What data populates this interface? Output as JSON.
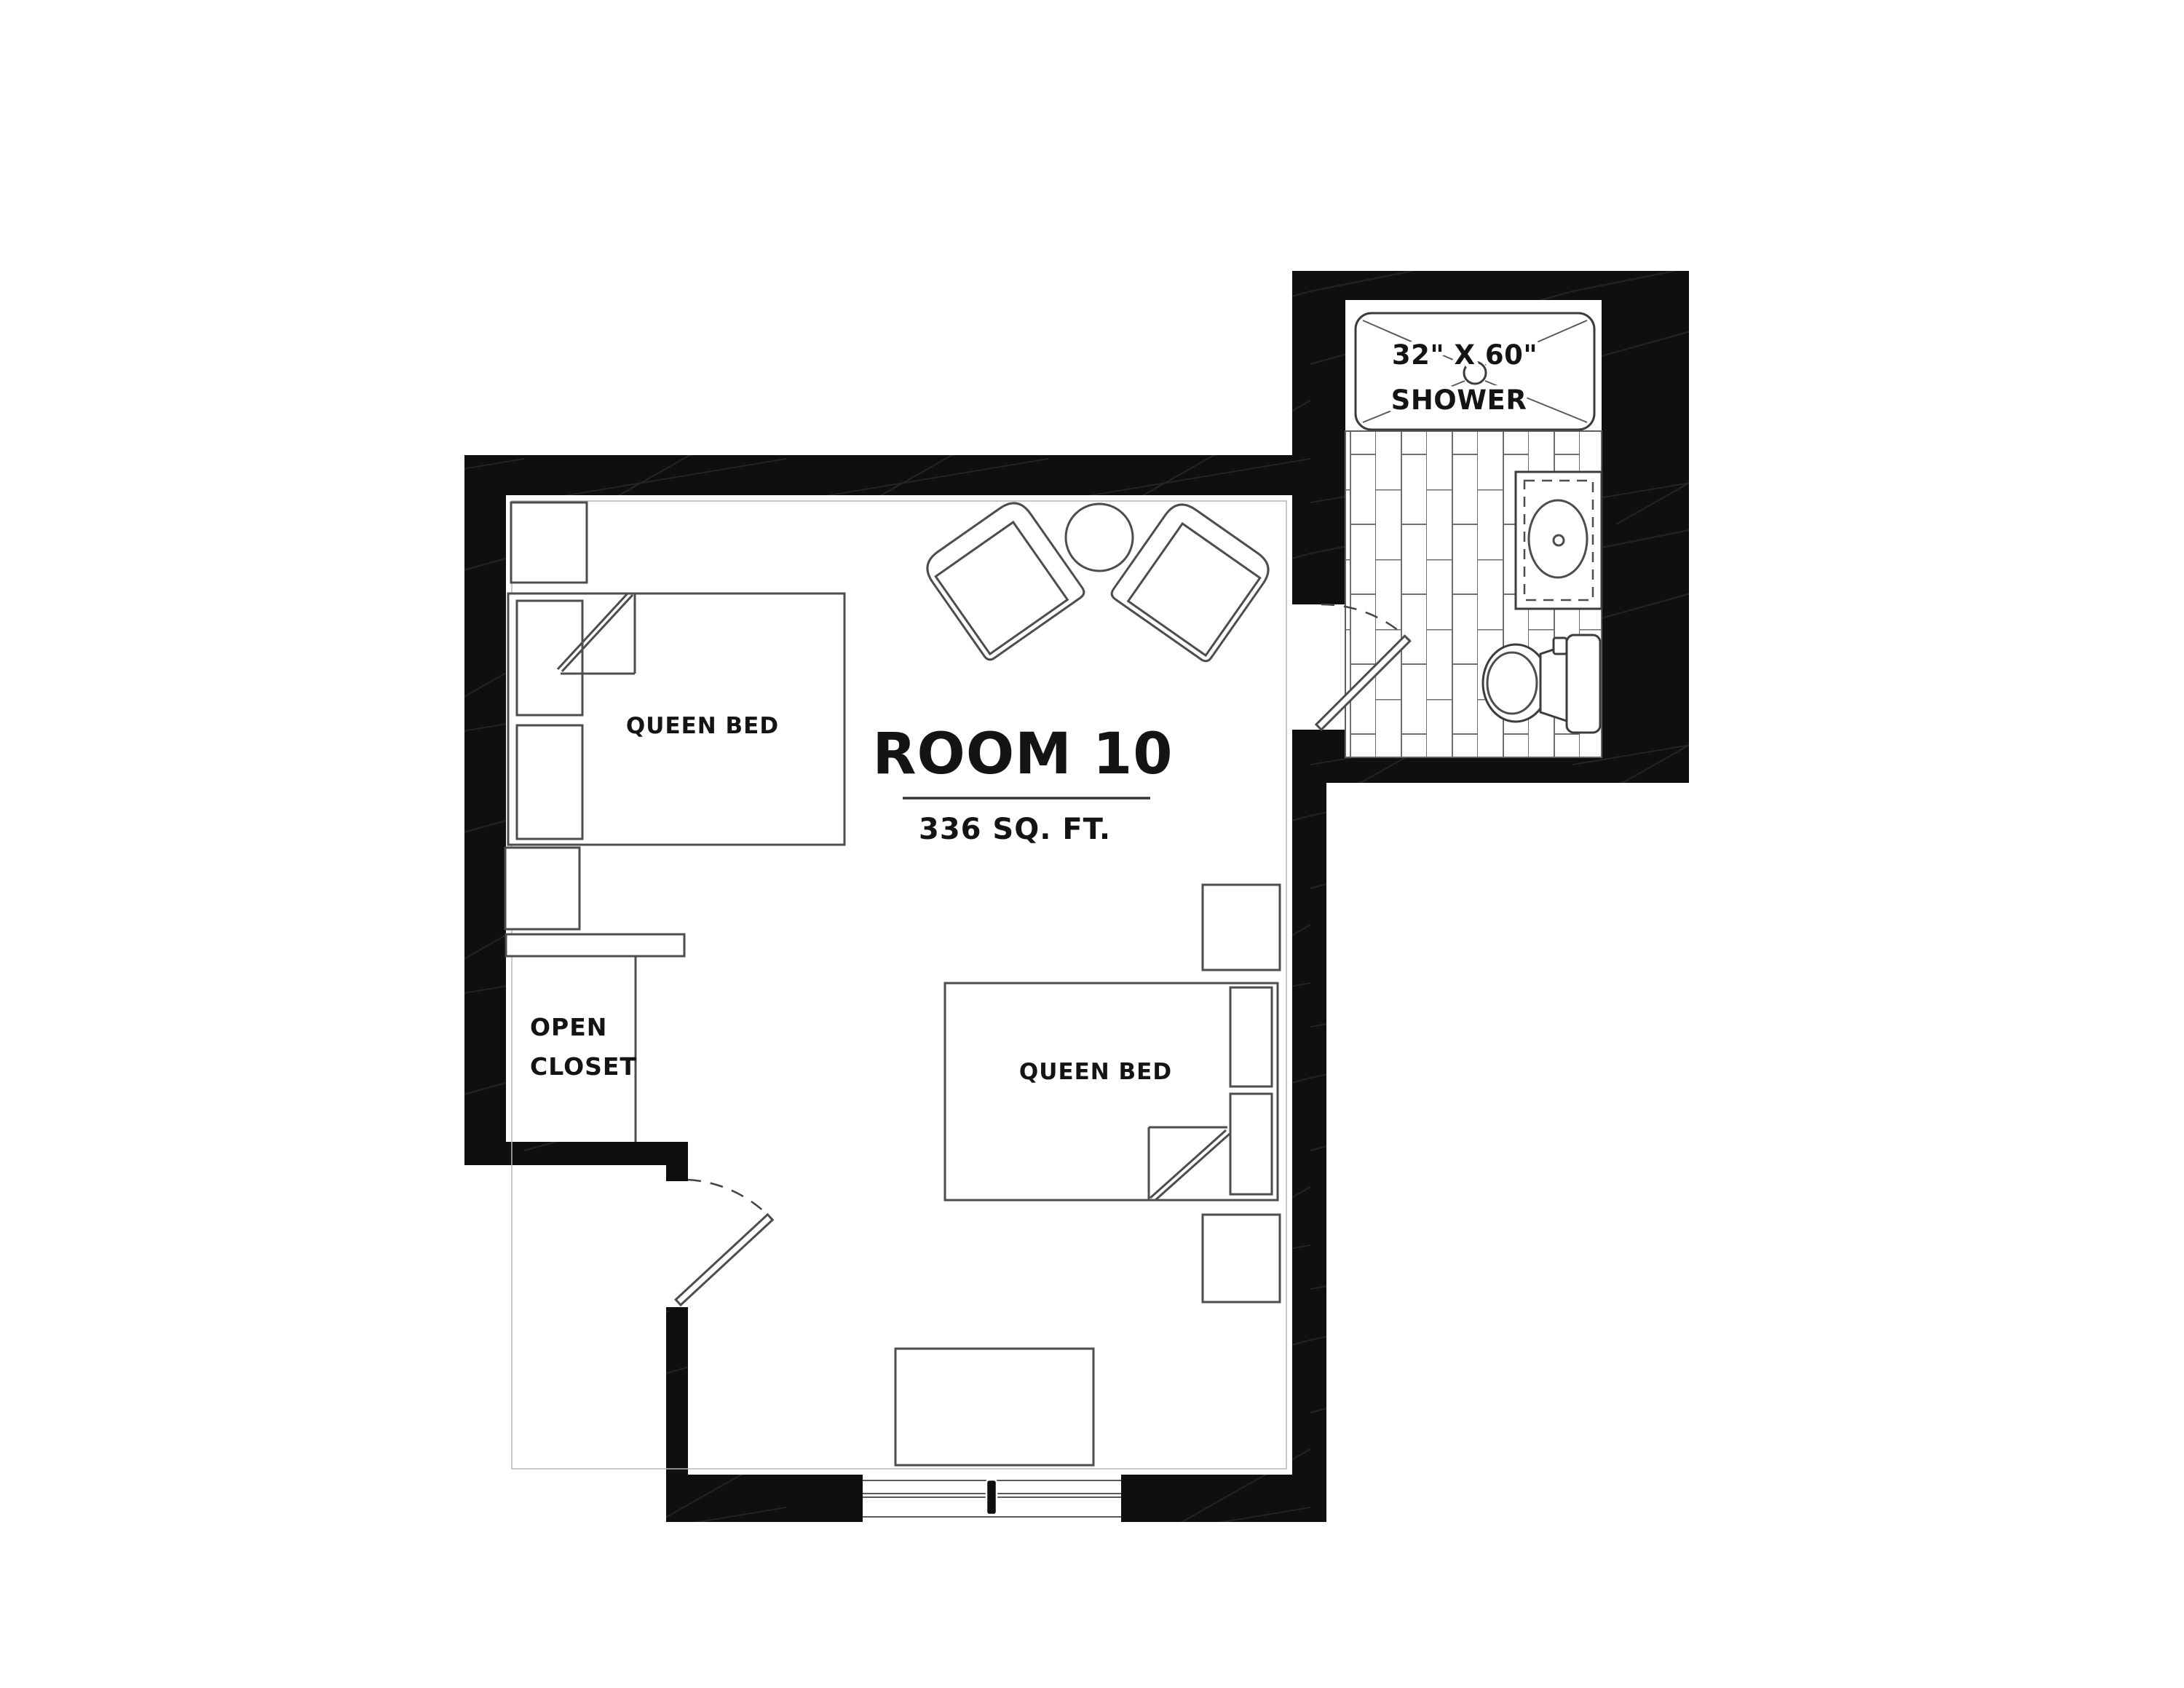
{
  "plan": {
    "title": "ROOM 10",
    "area": "336 SQ. FT.",
    "beds": [
      {
        "label": "QUEEN BED"
      },
      {
        "label": "QUEEN BED"
      }
    ],
    "closet": {
      "line1": "OPEN",
      "line2": "CLOSET"
    },
    "bathroom": {
      "shower_size": "32\" X 60\"",
      "shower_label": "SHOWER"
    },
    "colors": {
      "wall": "#0f0f0f",
      "line": "#4d4d4d",
      "fixture": "#3c3c3c",
      "tile": "#6f6f6f",
      "text": "#141414",
      "background": "#ffffff",
      "arc": "#444444"
    }
  }
}
